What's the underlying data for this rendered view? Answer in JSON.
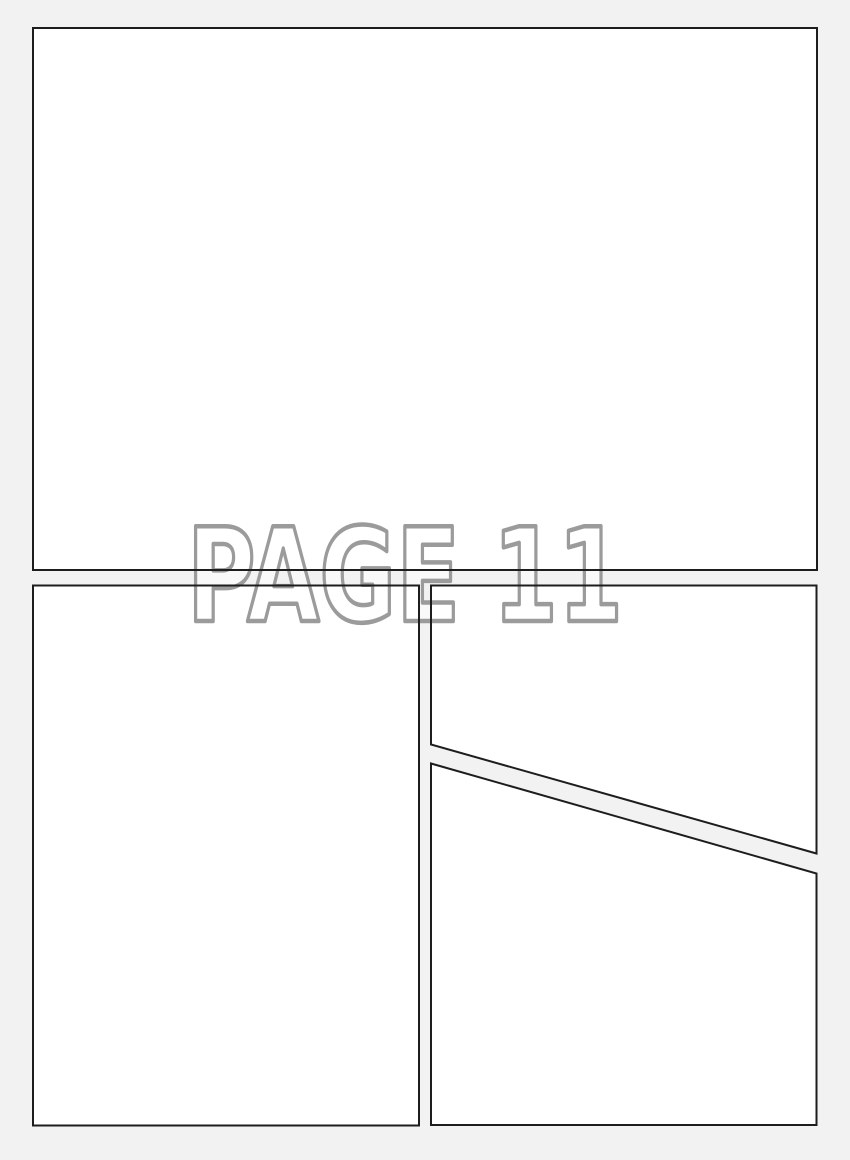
{
  "page": {
    "label": "PAGE 11",
    "colors": {
      "background": "#f2f2f2",
      "panel_fill": "#ffffff",
      "panel_border": "#1d1d1d",
      "label_outline": "#9b9b9b",
      "label_fill": "rgba(255,255,255,0.55)"
    },
    "panels": [
      {
        "name": "top",
        "shape": "rectangle"
      },
      {
        "name": "bottom-left",
        "shape": "rectangle"
      },
      {
        "name": "top-right",
        "shape": "diagonal-cut-bottom"
      },
      {
        "name": "bottom-right",
        "shape": "diagonal-cut-top"
      }
    ]
  }
}
